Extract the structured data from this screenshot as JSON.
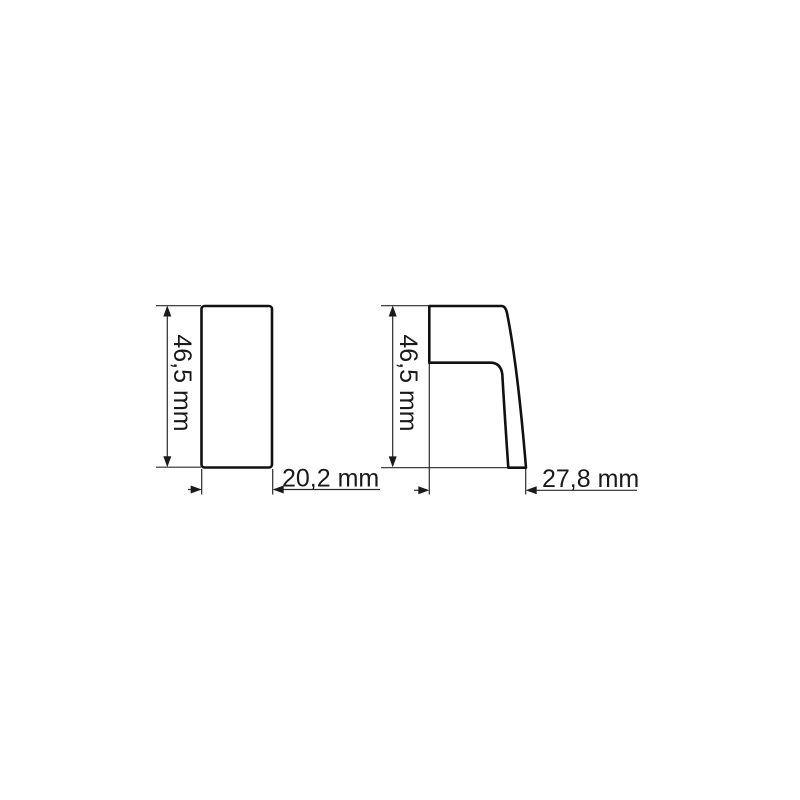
{
  "drawing": {
    "background_color": "#ffffff",
    "line_color": "#1a1a1a",
    "front_view": {
      "height_label": "46,5 mm",
      "width_label": "20,2 mm"
    },
    "side_view": {
      "height_label": "46,5 mm",
      "width_label": "27,8 mm"
    }
  }
}
